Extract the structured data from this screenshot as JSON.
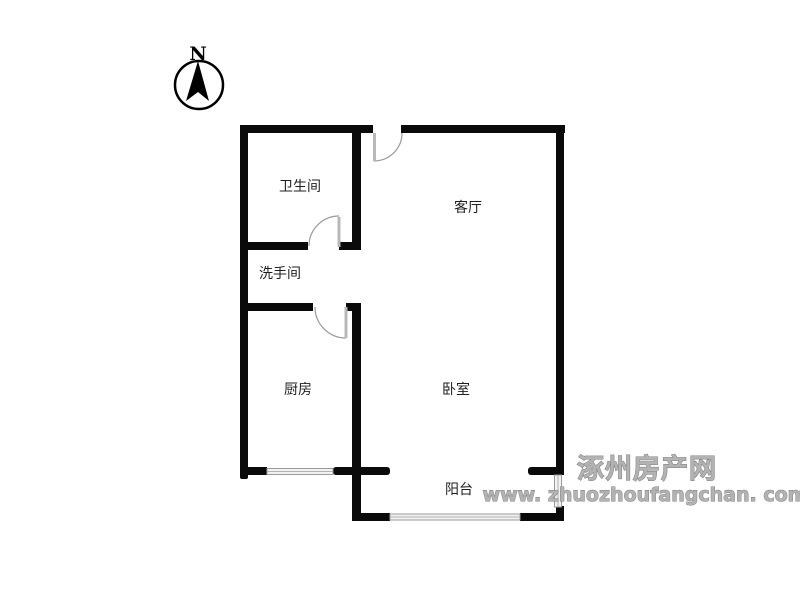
{
  "compass": {
    "label": "N"
  },
  "rooms": {
    "bathroom": "卫生间",
    "living_room": "客厅",
    "washroom": "洗手间",
    "kitchen": "厨房",
    "bedroom": "卧室",
    "balcony": "阳台"
  },
  "watermark": {
    "site_name": "涿州房产网",
    "site_url": "www. zhuozhoufangchan. com"
  },
  "colors": {
    "background": "#ffffff",
    "wall": "#0a0a0a",
    "door_leaf": "#b8b8b8",
    "door_arc": "#9a9a9a",
    "window_frame": "#9b9b9b",
    "window_fill": "#f2f2f2",
    "label_text": "#1f1f1f",
    "watermark_text": "#8f8f8f"
  }
}
